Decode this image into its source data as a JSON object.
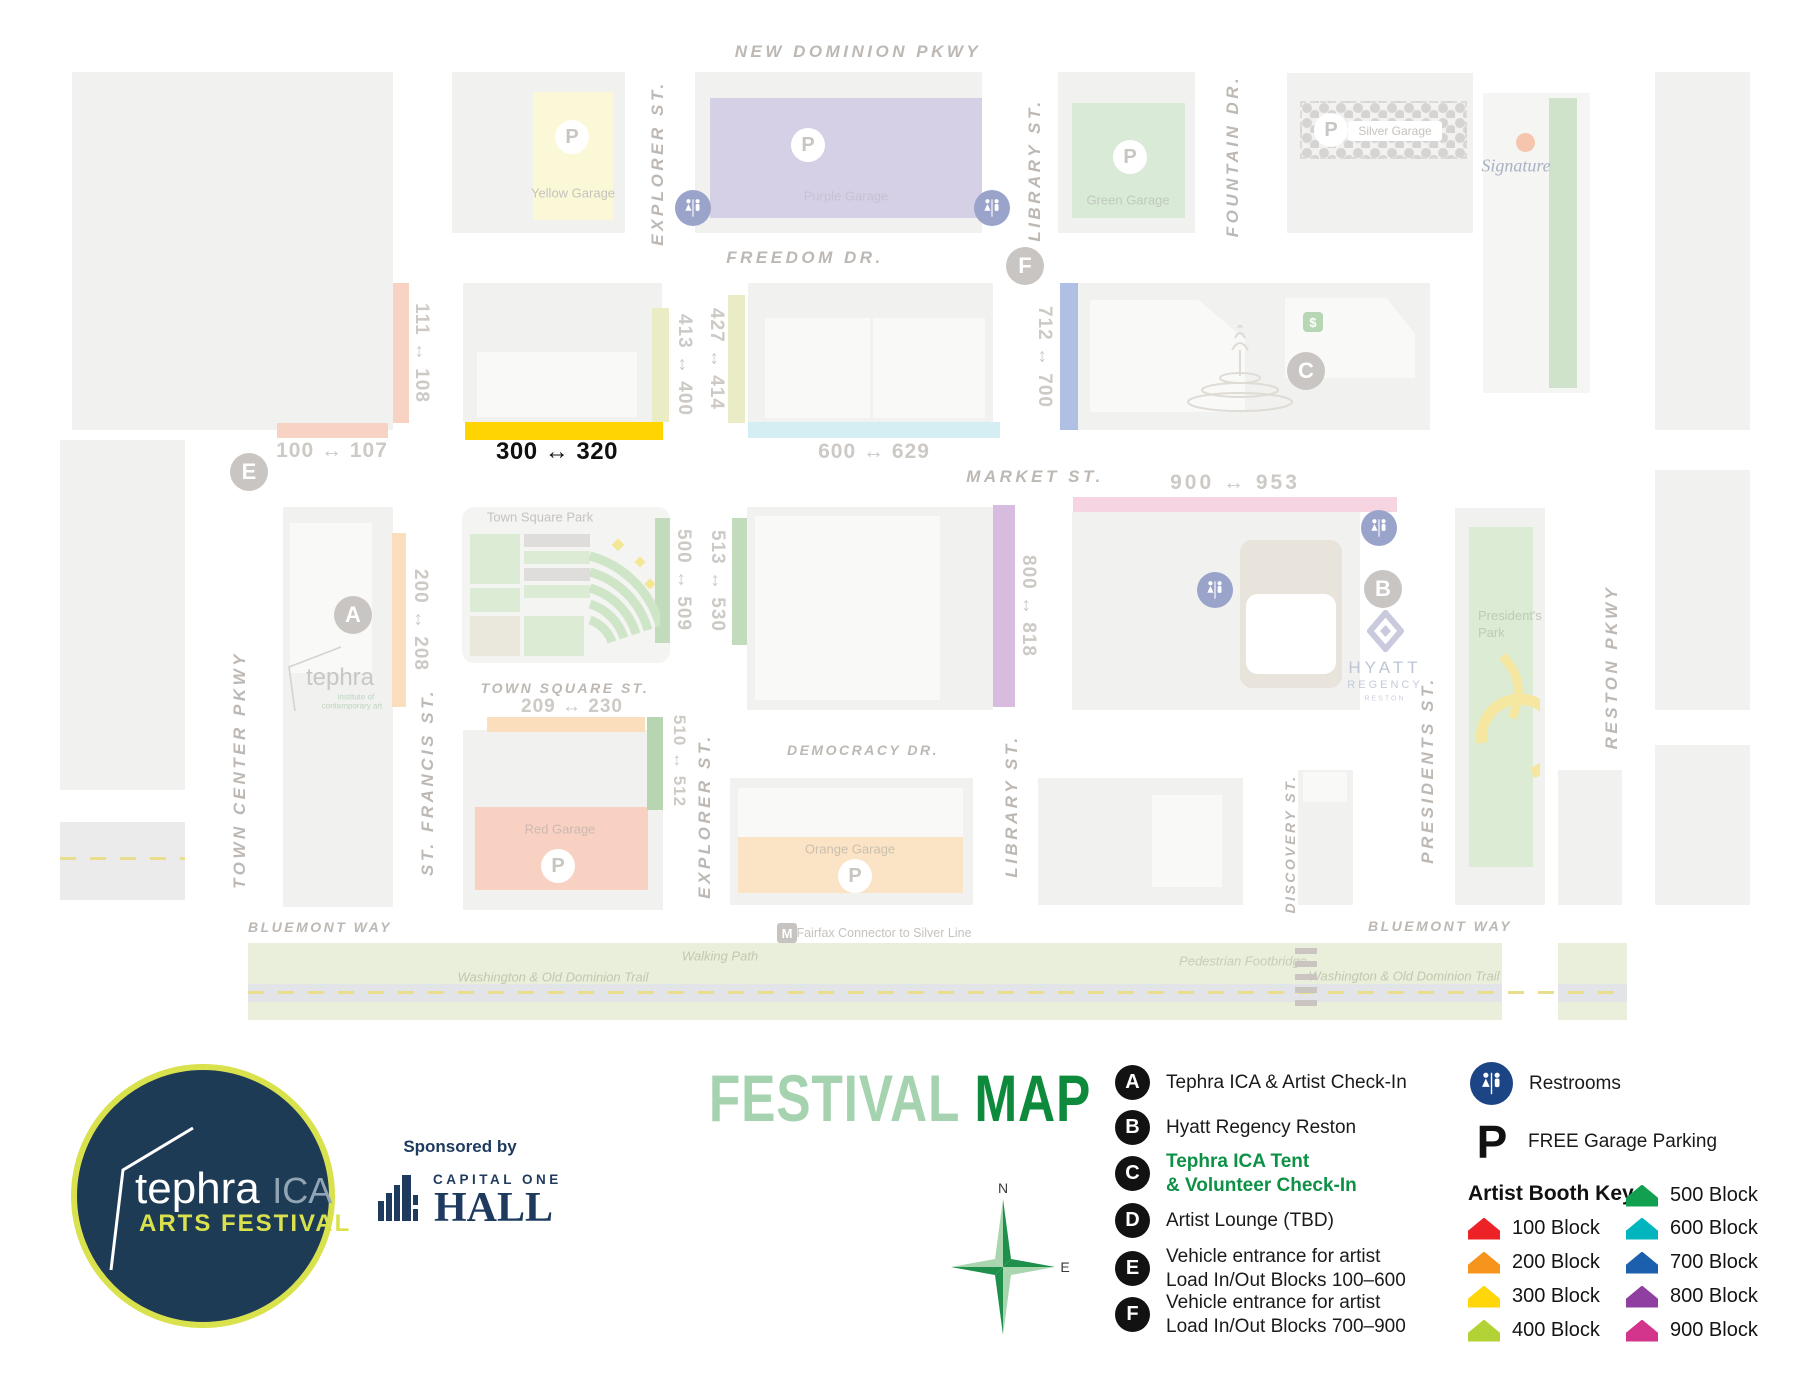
{
  "map": {
    "streets": {
      "new_dominion_pkwy": "NEW DOMINION PKWY",
      "freedom_dr": "FREEDOM DR.",
      "market_st": "MARKET ST.",
      "town_square_st": "TOWN SQUARE ST.",
      "democracy_dr": "DEMOCRACY DR.",
      "bluemont_way": "BLUEMONT WAY",
      "explorer_st": "EXPLORER ST.",
      "library_st": "LIBRARY ST.",
      "fountain_dr": "FOUNTAIN DR.",
      "town_center_pkwy": "TOWN CENTER PKWY",
      "st_francis_st": "ST. FRANCIS ST.",
      "discovery_st": "DISCOVERY ST.",
      "presidents_st": "PRESIDENTS ST.",
      "reston_pkwy": "RESTON PKWY"
    },
    "blocks": {
      "b100": "100 ↔ 107",
      "b111": "111 ↔ 108",
      "b200": "200 ↔ 208",
      "b209": "209 ↔ 230",
      "b300": "300 ↔ 320",
      "b413": "413 ↔ 400",
      "b427": "427 ↔ 414",
      "b500": "500 ↔ 509",
      "b510": "510 ↔ 512",
      "b513": "513 ↔ 530",
      "b600": "600 ↔ 629",
      "b712": "712 ↔ 700",
      "b800": "800 ↔ 818",
      "b900": "900 ↔ 953"
    },
    "garages": {
      "yellow": "Yellow Garage",
      "purple": "Purple Garage",
      "green": "Green Garage",
      "silver": "Silver Garage",
      "red": "Red Garage",
      "orange": "Orange Garage"
    },
    "places": {
      "town_square_park": "Town Square Park",
      "tephra": "tephra",
      "tephra_sub1": "institute of",
      "tephra_sub2": "contemporary art",
      "signature": "Signature",
      "presidents_park_1": "President's",
      "presidents_park_2": "Park",
      "hyatt1": "HYATT",
      "hyatt2": "REGENCY",
      "hyatt3": "RESTON"
    },
    "paths": {
      "walking_path": "Walking Path",
      "wod_trail": "Washington & Old Dominion Trail",
      "footbridge": "Pedestrian Footbridge",
      "fairfax": "Fairfax Connector to Silver Line"
    },
    "markers": {
      "a": "A",
      "b": "B",
      "c": "C",
      "e": "E",
      "f": "F"
    },
    "p": "P",
    "m": "M",
    "dollar": "$",
    "highlight_yellow": "#ffd400"
  },
  "legend": {
    "title_light": "FESTIVAL",
    "title_dark": "MAP",
    "title_light_color": "#a6d3af",
    "title_dark_color": "#0e8a3c",
    "sponsored_by": "Sponsored by",
    "capital_one": "CAPITAL ONE",
    "hall": "HALL",
    "logo": {
      "name": "tephra",
      "ica": "ICA",
      "festival": "ARTS FESTIVAL"
    },
    "compass": {
      "n": "N",
      "e": "E"
    },
    "highlight_color": "#0e9146",
    "items": [
      {
        "letter": "A",
        "lines": [
          "Tephra ICA & Artist Check-In"
        ]
      },
      {
        "letter": "B",
        "lines": [
          "Hyatt Regency Reston"
        ]
      },
      {
        "letter": "C",
        "lines": [
          "Tephra ICA Tent",
          "& Volunteer Check-In"
        ]
      },
      {
        "letter": "D",
        "lines": [
          "Artist Lounge (TBD)"
        ]
      },
      {
        "letter": "E",
        "lines": [
          "Vehicle entrance for artist",
          "Load In/Out Blocks 100–600"
        ]
      },
      {
        "letter": "F",
        "lines": [
          "Vehicle entrance for artist",
          "Load In/Out Blocks 700–900"
        ]
      }
    ],
    "restrooms": "Restrooms",
    "parking": "FREE Garage Parking",
    "booth_key": {
      "title": "Artist Booth Key",
      "col1": [
        {
          "label": "100 Block",
          "color": "#ec2227"
        },
        {
          "label": "200 Block",
          "color": "#f7941d"
        },
        {
          "label": "300 Block",
          "color": "#ffd60a"
        },
        {
          "label": "400 Block",
          "color": "#b2d235"
        }
      ],
      "col2": [
        {
          "label": "500 Block",
          "color": "#10a04f"
        },
        {
          "label": "600 Block",
          "color": "#00b5bd"
        },
        {
          "label": "700 Block",
          "color": "#1b5fad"
        },
        {
          "label": "800 Block",
          "color": "#8e3fa0"
        },
        {
          "label": "900 Block",
          "color": "#d4358c"
        }
      ]
    }
  }
}
